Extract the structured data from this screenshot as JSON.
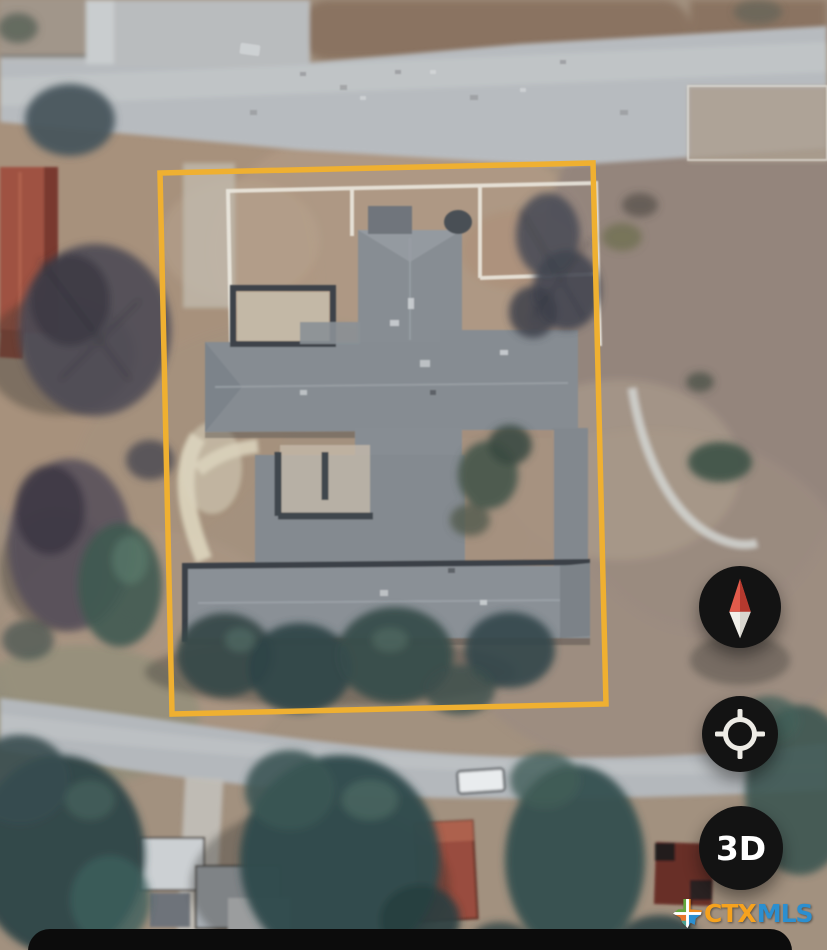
{
  "view": {
    "type": "satellite-map"
  },
  "parcel": {
    "outline_color": "#F2B02A"
  },
  "controls": {
    "compass": {
      "icon": "compass-needle",
      "north_color": "#E25B4B",
      "south_color": "#F2F0EA",
      "background": "#131313"
    },
    "my_location": {
      "icon": "locate-crosshair",
      "color": "#EDEBE5",
      "background": "#141414"
    },
    "view_3d": {
      "label": "3D",
      "text_color": "#FFFFFF",
      "background": "#131313"
    }
  },
  "watermark": {
    "icon": "texas-state",
    "part1": "CTX",
    "part2": "MLS",
    "part1_color": "#F6A21E",
    "part2_color": "#2B8FD0"
  },
  "bottom_sheet": {
    "background": "#0C0C0C"
  }
}
